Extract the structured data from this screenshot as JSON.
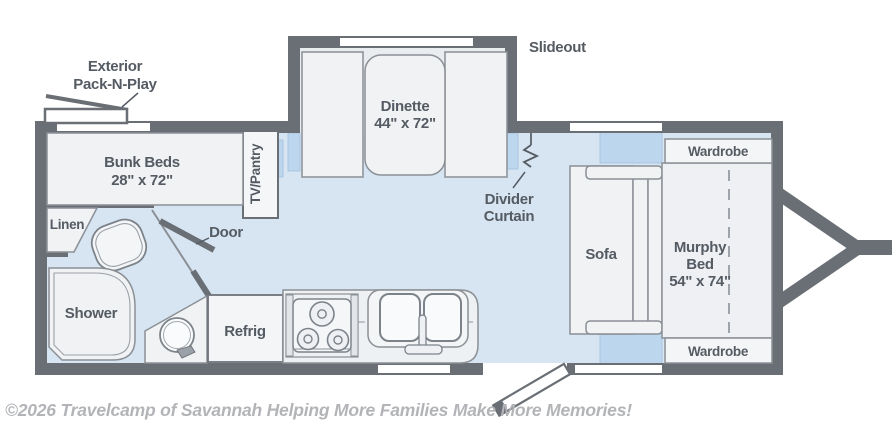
{
  "colors": {
    "wall": "#6a6f75",
    "floor": "#d7e5f2",
    "slideout_floor": "#e9edf0",
    "furniture": "#f0f2f4",
    "accent_blue": "#bcd6ee",
    "outline": "#8b9096",
    "label_text": "#555b63",
    "watermark_text": "#b2b4b7"
  },
  "areas": {
    "slideout": {
      "label": "Slideout"
    },
    "exterior_pack_n_play": {
      "label_line1": "Exterior",
      "label_line2": "Pack-N-Play"
    },
    "dinette": {
      "label": "Dinette",
      "dims": "44\" x 72\""
    },
    "bunk_beds": {
      "label": "Bunk Beds",
      "dims": "28\" x 72\""
    },
    "tv_pantry": {
      "label": "TV/Pantry"
    },
    "linen": {
      "label": "Linen"
    },
    "bath_door": {
      "label": "Door"
    },
    "shower": {
      "label": "Shower"
    },
    "refrigerator": {
      "label": "Refrig"
    },
    "divider_curtain": {
      "label_line1": "Divider",
      "label_line2": "Curtain"
    },
    "sofa": {
      "label": "Sofa"
    },
    "murphy_bed": {
      "label_line1": "Murphy",
      "label_line2": "Bed",
      "dims": "54\" x 74\""
    },
    "wardrobe_top": {
      "label": "Wardrobe"
    },
    "wardrobe_bottom": {
      "label": "Wardrobe"
    }
  },
  "watermark": "©2026 Travelcamp of Savannah Helping More Families Make More Memories!"
}
